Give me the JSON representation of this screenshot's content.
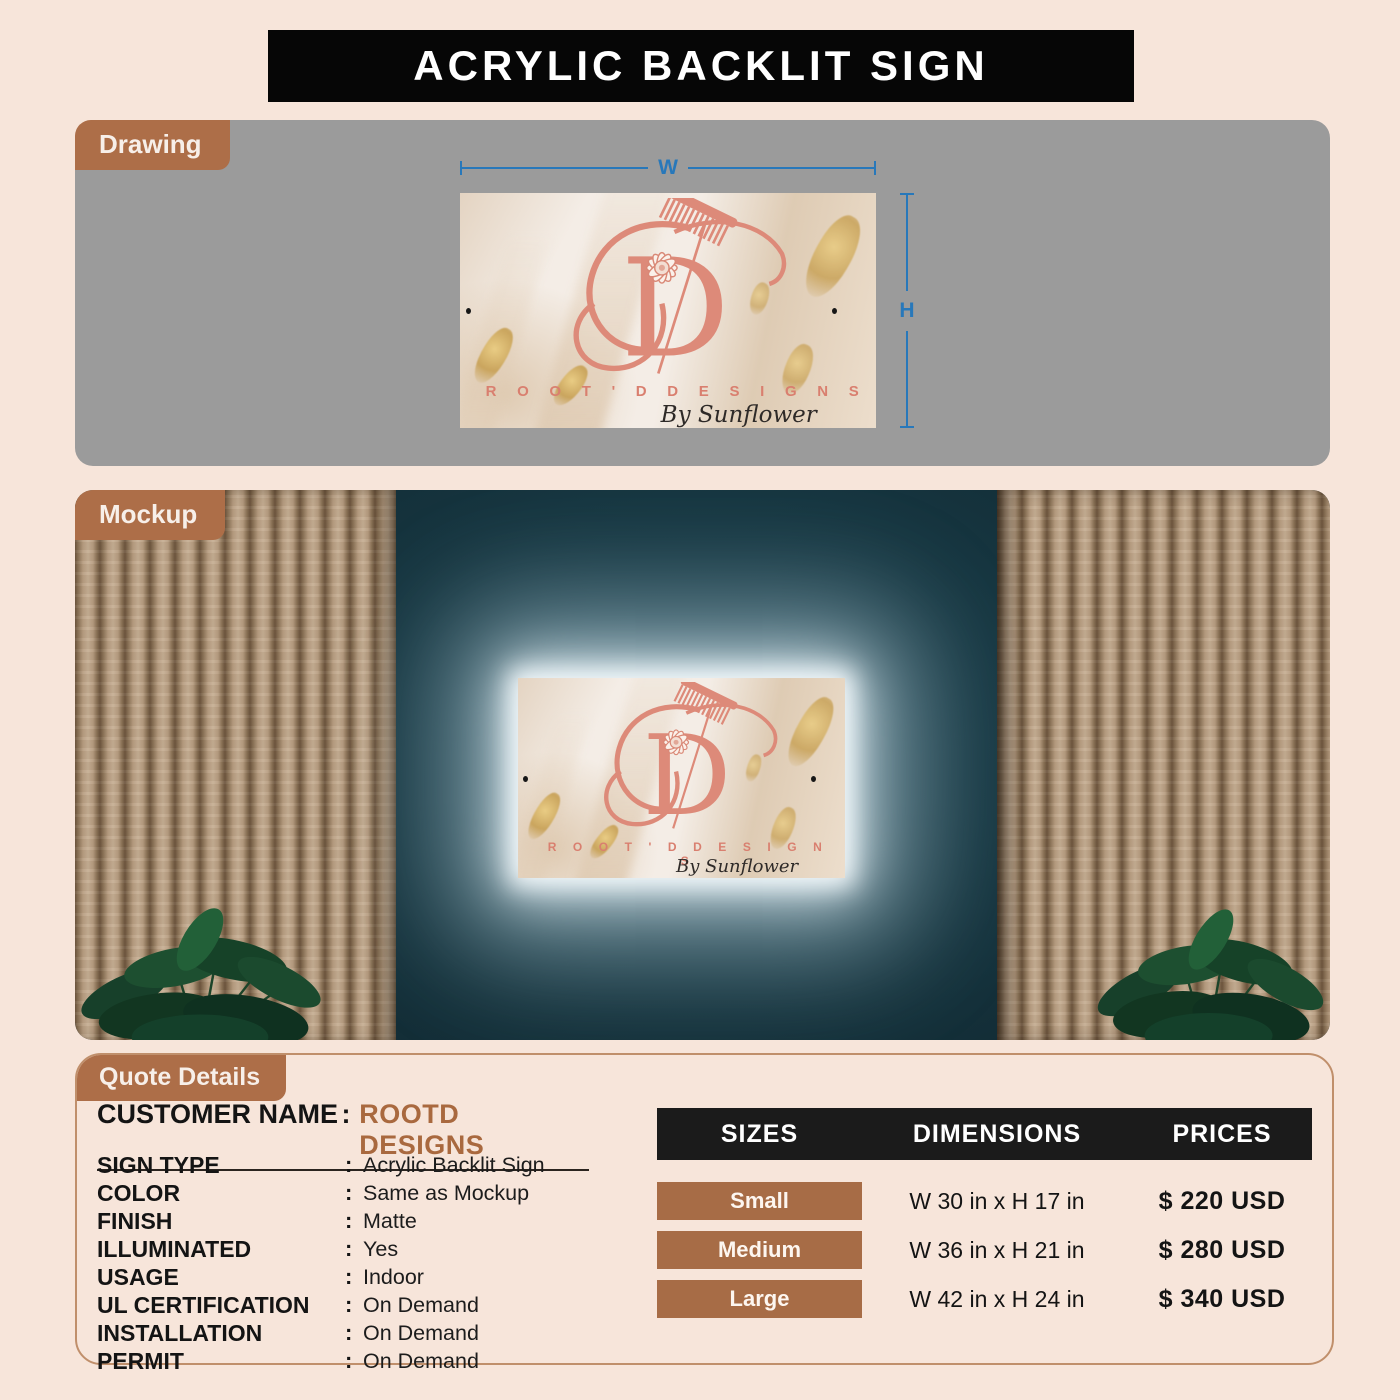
{
  "header": {
    "title": "ACRYLIC BACKLIT SIGN"
  },
  "drawing": {
    "tab": "Drawing",
    "width_label": "W",
    "height_label": "H"
  },
  "mockup": {
    "tab": "Mockup"
  },
  "sign": {
    "brand": "R O O T ' D   D E S I G N S",
    "byline": "By Sunflower"
  },
  "quote": {
    "tab": "Quote Details",
    "separator": ":",
    "customer": {
      "label": "CUSTOMER NAME",
      "value": "ROOTD DESIGNS"
    },
    "details": [
      {
        "label": "SIGN TYPE",
        "value": "Acrylic Backlit Sign"
      },
      {
        "label": "COLOR",
        "value": "Same as Mockup"
      },
      {
        "label": "FINISH",
        "value": "Matte"
      },
      {
        "label": "ILLUMINATED",
        "value": "Yes"
      },
      {
        "label": "USAGE",
        "value": "Indoor"
      },
      {
        "label": "UL CERTIFICATION",
        "value": "On Demand"
      },
      {
        "label": "INSTALLATION",
        "value": "On Demand"
      },
      {
        "label": "PERMIT",
        "value": "On Demand"
      }
    ]
  },
  "pricing": {
    "columns": [
      "SIZES",
      "DIMENSIONS",
      "PRICES"
    ],
    "rows": [
      {
        "size": "Small",
        "dimensions": "W 30 in x H 17 in",
        "price": "$ 220 USD"
      },
      {
        "size": "Medium",
        "dimensions": "W 36 in x H 21 in",
        "price": "$ 280 USD"
      },
      {
        "size": "Large",
        "dimensions": "W 42 in x H 24 in",
        "price": "$ 340 USD"
      }
    ]
  },
  "colors": {
    "page_bg": "#f7e5da",
    "accent_brown": "#ad6e48",
    "banner_black": "#060606",
    "dimension_blue": "#2878ba",
    "wall_teal": "#16343f",
    "logo_salmon": "#dd8a79"
  }
}
